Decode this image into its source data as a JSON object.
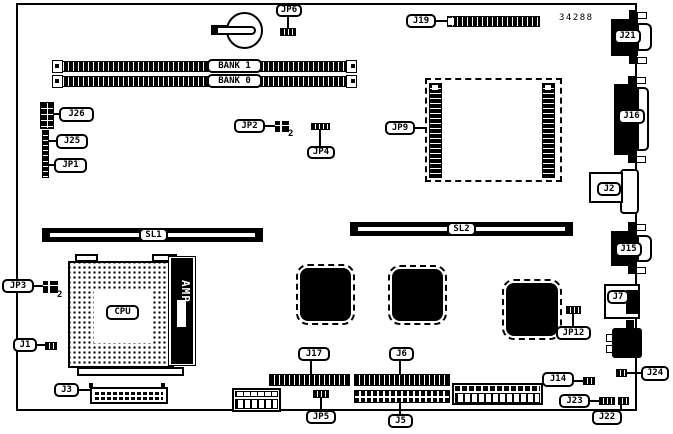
{
  "diagram": {
    "part_number": "34288",
    "pin2_marker": "2"
  },
  "labels": {
    "jp6": "JP6",
    "bank1": "BANK 1",
    "bank0": "BANK 0",
    "j26": "J26",
    "j25": "J25",
    "jp1": "JP1",
    "jp2": "JP2",
    "jp4": "JP4",
    "j19": "J19",
    "jp9": "JP9",
    "j21": "J21",
    "j16": "J16",
    "j2": "J2",
    "sl1": "SL1",
    "sl2": "SL2",
    "j15": "J15",
    "j7": "J7",
    "jp3": "JP3",
    "cpu": "CPU",
    "amp": "AMP",
    "j1": "J1",
    "jp12": "JP12",
    "j17": "J17",
    "j6": "J6",
    "j24": "J24",
    "j3": "J3",
    "jp5": "JP5",
    "j5": "J5",
    "j14": "J14",
    "j23": "J23",
    "j22": "J22"
  }
}
